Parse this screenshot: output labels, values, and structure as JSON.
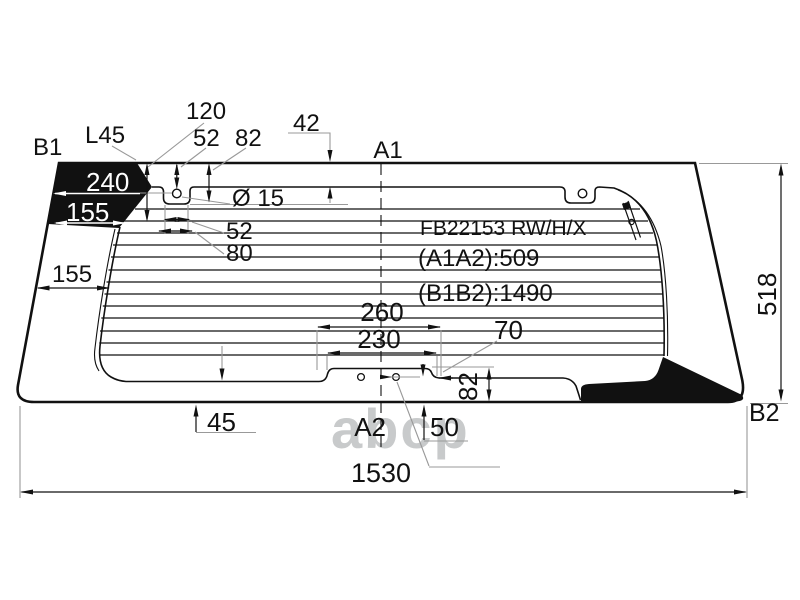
{
  "drawing": {
    "part_code": "FB22153 RW/H/X",
    "dim_a1a2": "(A1A2):509",
    "dim_b1b2": "(B1B2):1490",
    "watermark": "abcp",
    "points": {
      "a1": "A1",
      "a2": "A2",
      "b1": "B1",
      "b2": "B2"
    },
    "dims": {
      "l45": "L45",
      "d120": "120",
      "d52_top": "52",
      "d82_top": "82",
      "d42": "42",
      "d240": "240",
      "d155_band": "155",
      "d52_hole": "52",
      "d80": "80",
      "d155_left": "155",
      "dia15_top": "Ø 15",
      "d260": "260",
      "d230": "230",
      "d70": "70",
      "d82_bottom": "82",
      "d45": "45",
      "d50": "50",
      "dia15_bottom": "Ø 15",
      "d518": "518",
      "d1530": "1530"
    },
    "colors": {
      "ink": "#111111",
      "thin": "#999999",
      "watermark": "#c8cacb",
      "bg": "#ffffff"
    }
  }
}
